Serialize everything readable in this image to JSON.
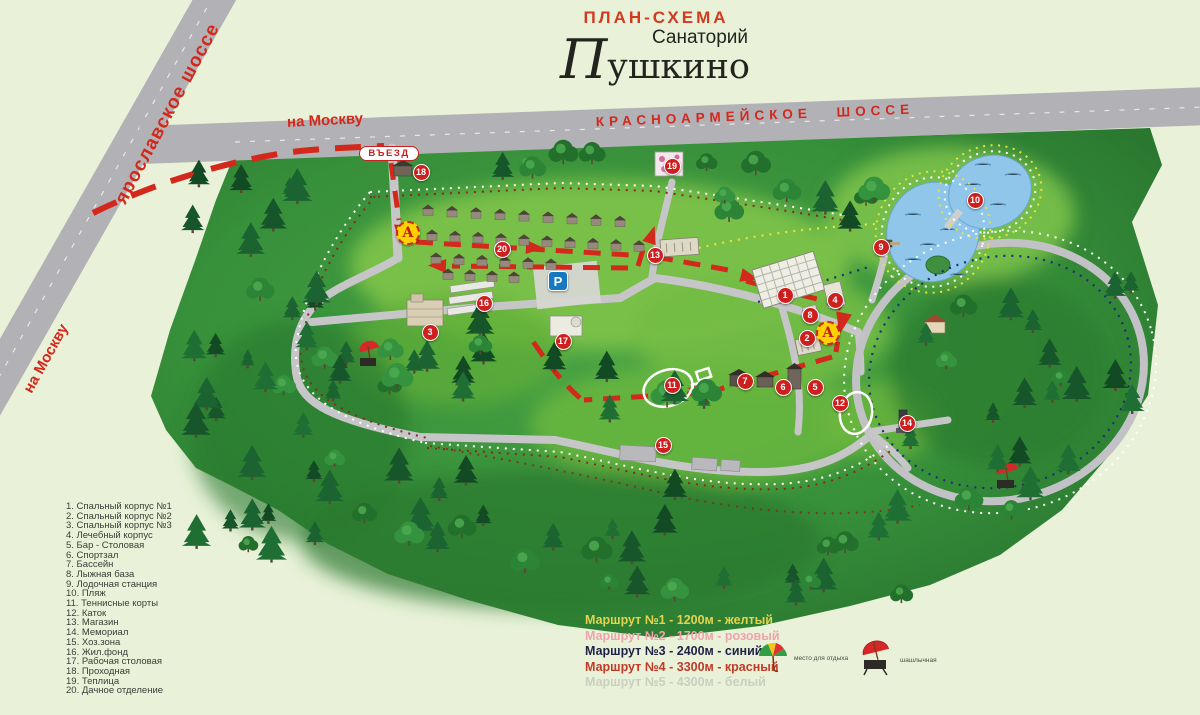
{
  "title": {
    "plan": "ПЛАН-СХЕМА",
    "subtitle": "Санаторий",
    "name": "Пушкино"
  },
  "roads": {
    "yaroslavskoe": "ярославское шоссе",
    "krasnoarmeyskoe": "КРАСНОАРМЕЙСКОЕ ШОССЕ",
    "to_moscow_top": "на Москву",
    "to_moscow_bottom": "на Москву",
    "entrance_label": "ВЪЕЗД"
  },
  "map": {
    "parking_letter": "P",
    "bus_stop_letter": "А",
    "bus_stops": [
      {
        "x": 408,
        "y": 233
      },
      {
        "x": 828,
        "y": 333
      }
    ],
    "parking": {
      "x": 558,
      "y": 281
    },
    "entrance": {
      "x": 389,
      "y": 153
    },
    "markers": [
      {
        "n": 1,
        "x": 785,
        "y": 295
      },
      {
        "n": 2,
        "x": 807,
        "y": 338
      },
      {
        "n": 3,
        "x": 430,
        "y": 332
      },
      {
        "n": 4,
        "x": 835,
        "y": 300
      },
      {
        "n": 5,
        "x": 815,
        "y": 387
      },
      {
        "n": 6,
        "x": 783,
        "y": 387
      },
      {
        "n": 7,
        "x": 745,
        "y": 381
      },
      {
        "n": 8,
        "x": 810,
        "y": 315
      },
      {
        "n": 9,
        "x": 881,
        "y": 247
      },
      {
        "n": 10,
        "x": 975,
        "y": 200
      },
      {
        "n": 11,
        "x": 672,
        "y": 385
      },
      {
        "n": 12,
        "x": 840,
        "y": 403
      },
      {
        "n": 13,
        "x": 655,
        "y": 255
      },
      {
        "n": 14,
        "x": 907,
        "y": 423
      },
      {
        "n": 15,
        "x": 663,
        "y": 445
      },
      {
        "n": 16,
        "x": 484,
        "y": 303
      },
      {
        "n": 17,
        "x": 563,
        "y": 341
      },
      {
        "n": 18,
        "x": 421,
        "y": 172
      },
      {
        "n": 19,
        "x": 672,
        "y": 166
      },
      {
        "n": 20,
        "x": 502,
        "y": 249
      }
    ]
  },
  "legend": {
    "items": [
      {
        "n": "1",
        "label": "Спальный корпус №1"
      },
      {
        "n": "2",
        "label": "Спальный корпус №2"
      },
      {
        "n": "3",
        "label": "Спальный корпус №3"
      },
      {
        "n": "4",
        "label": "Лечебный корпус"
      },
      {
        "n": "5",
        "label": "Бар - Столовая"
      },
      {
        "n": "6",
        "label": "Спортзал"
      },
      {
        "n": "7",
        "label": "Бассейн"
      },
      {
        "n": "8",
        "label": "Лыжная база"
      },
      {
        "n": "9",
        "label": "Лодочная станция"
      },
      {
        "n": "10",
        "label": "Пляж"
      },
      {
        "n": "11",
        "label": "Теннисные корты"
      },
      {
        "n": "12",
        "label": "Каток"
      },
      {
        "n": "13",
        "label": "Магазин"
      },
      {
        "n": "14",
        "label": "Мемориал"
      },
      {
        "n": "15",
        "label": "Хоз.зона"
      },
      {
        "n": "16",
        "label": "Жил.фонд"
      },
      {
        "n": "17",
        "label": "Рабочая столовая"
      },
      {
        "n": "18",
        "label": "Проходная"
      },
      {
        "n": "19",
        "label": "Теплица"
      },
      {
        "n": "20",
        "label": "Дачное отделение"
      }
    ]
  },
  "routes": [
    {
      "label": "Маршрут №1 - 1200м - желтый",
      "color": "#e3d44f"
    },
    {
      "label": "Маршрут №2 - 1700м - розовый",
      "color": "#f0a3aa"
    },
    {
      "label": "Маршрут №3 - 2400м - синий",
      "color": "#232347"
    },
    {
      "label": "Маршрут №4 - 3300м - красный",
      "color": "#c23a28"
    },
    {
      "label": "Маршрут №5 - 4300м - белый",
      "color": "#c9cfbf"
    }
  ],
  "poi_legend": [
    {
      "icon": "umbrella-multicolor-icon",
      "label": "место для отдыха"
    },
    {
      "icon": "umbrella-grill-icon",
      "label": "шашлычная"
    }
  ],
  "colors": {
    "route_red": "#d3281c",
    "marker_red": "#ce1e1e",
    "road_gray": "#b2b2b6",
    "pond_blue": "#8fc6ea",
    "bg": "#e9f2d8",
    "bus_stop_yellow": "#ffd200",
    "parking_blue": "#1678be",
    "trail_yellow": "#e8e23c",
    "trail_navy": "#1d2e77",
    "trail_white": "#ffffff",
    "trail_maroon": "#8a2a1a"
  }
}
